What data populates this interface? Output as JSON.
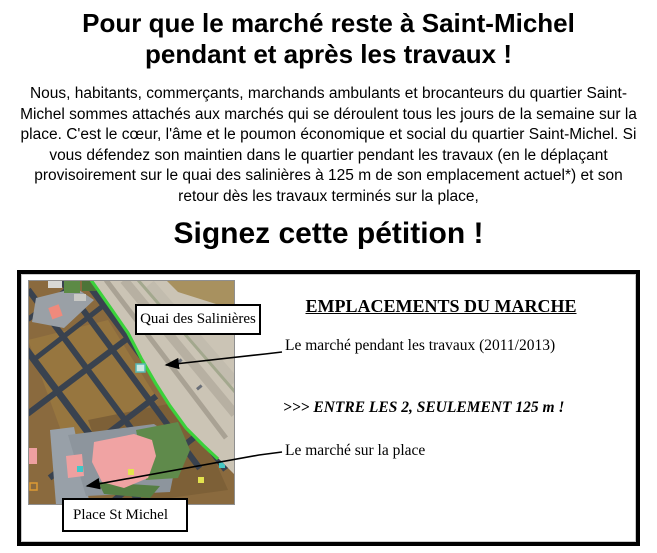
{
  "header": {
    "title_line1": "Pour que le marché reste à Saint-Michel",
    "title_line2": "pendant et après les travaux !",
    "intro": "Nous, habitants, commerçants, marchands ambulants et brocanteurs du quartier Saint-Michel sommes attachés aux marchés qui se déroulent tous les jours de la semaine sur la place. C'est le cœur, l'âme et le poumon économique et social du quartier Saint-Michel. Si vous défendez son maintien dans le quartier pendant les travaux (en le déplaçant provisoirement sur le quai des salinières à 125 m de son emplacement actuel*) et son retour dès les travaux terminés sur la place,",
    "cta": "Signez cette pétition !"
  },
  "map_panel": {
    "heading": "EMPLACEMENTS DU MARCHE",
    "annotation_travaux": "Le marché pendant les travaux (2011/2013)",
    "distance_note": ">>> ENTRE LES 2, SEULEMENT 125 m !",
    "annotation_place": "Le marché sur la place",
    "map_label_quai": "Quai des Salinières",
    "map_label_place": "Place St Michel"
  },
  "colors": {
    "route_green": "#3bd23b",
    "place_pink": "#f0a3a3",
    "quai_tan": "#cbc4b5",
    "water_brown": "#a8915f",
    "street_dark": "#39424f",
    "building_brown": "#8a6a3e",
    "border_black": "#000000"
  }
}
